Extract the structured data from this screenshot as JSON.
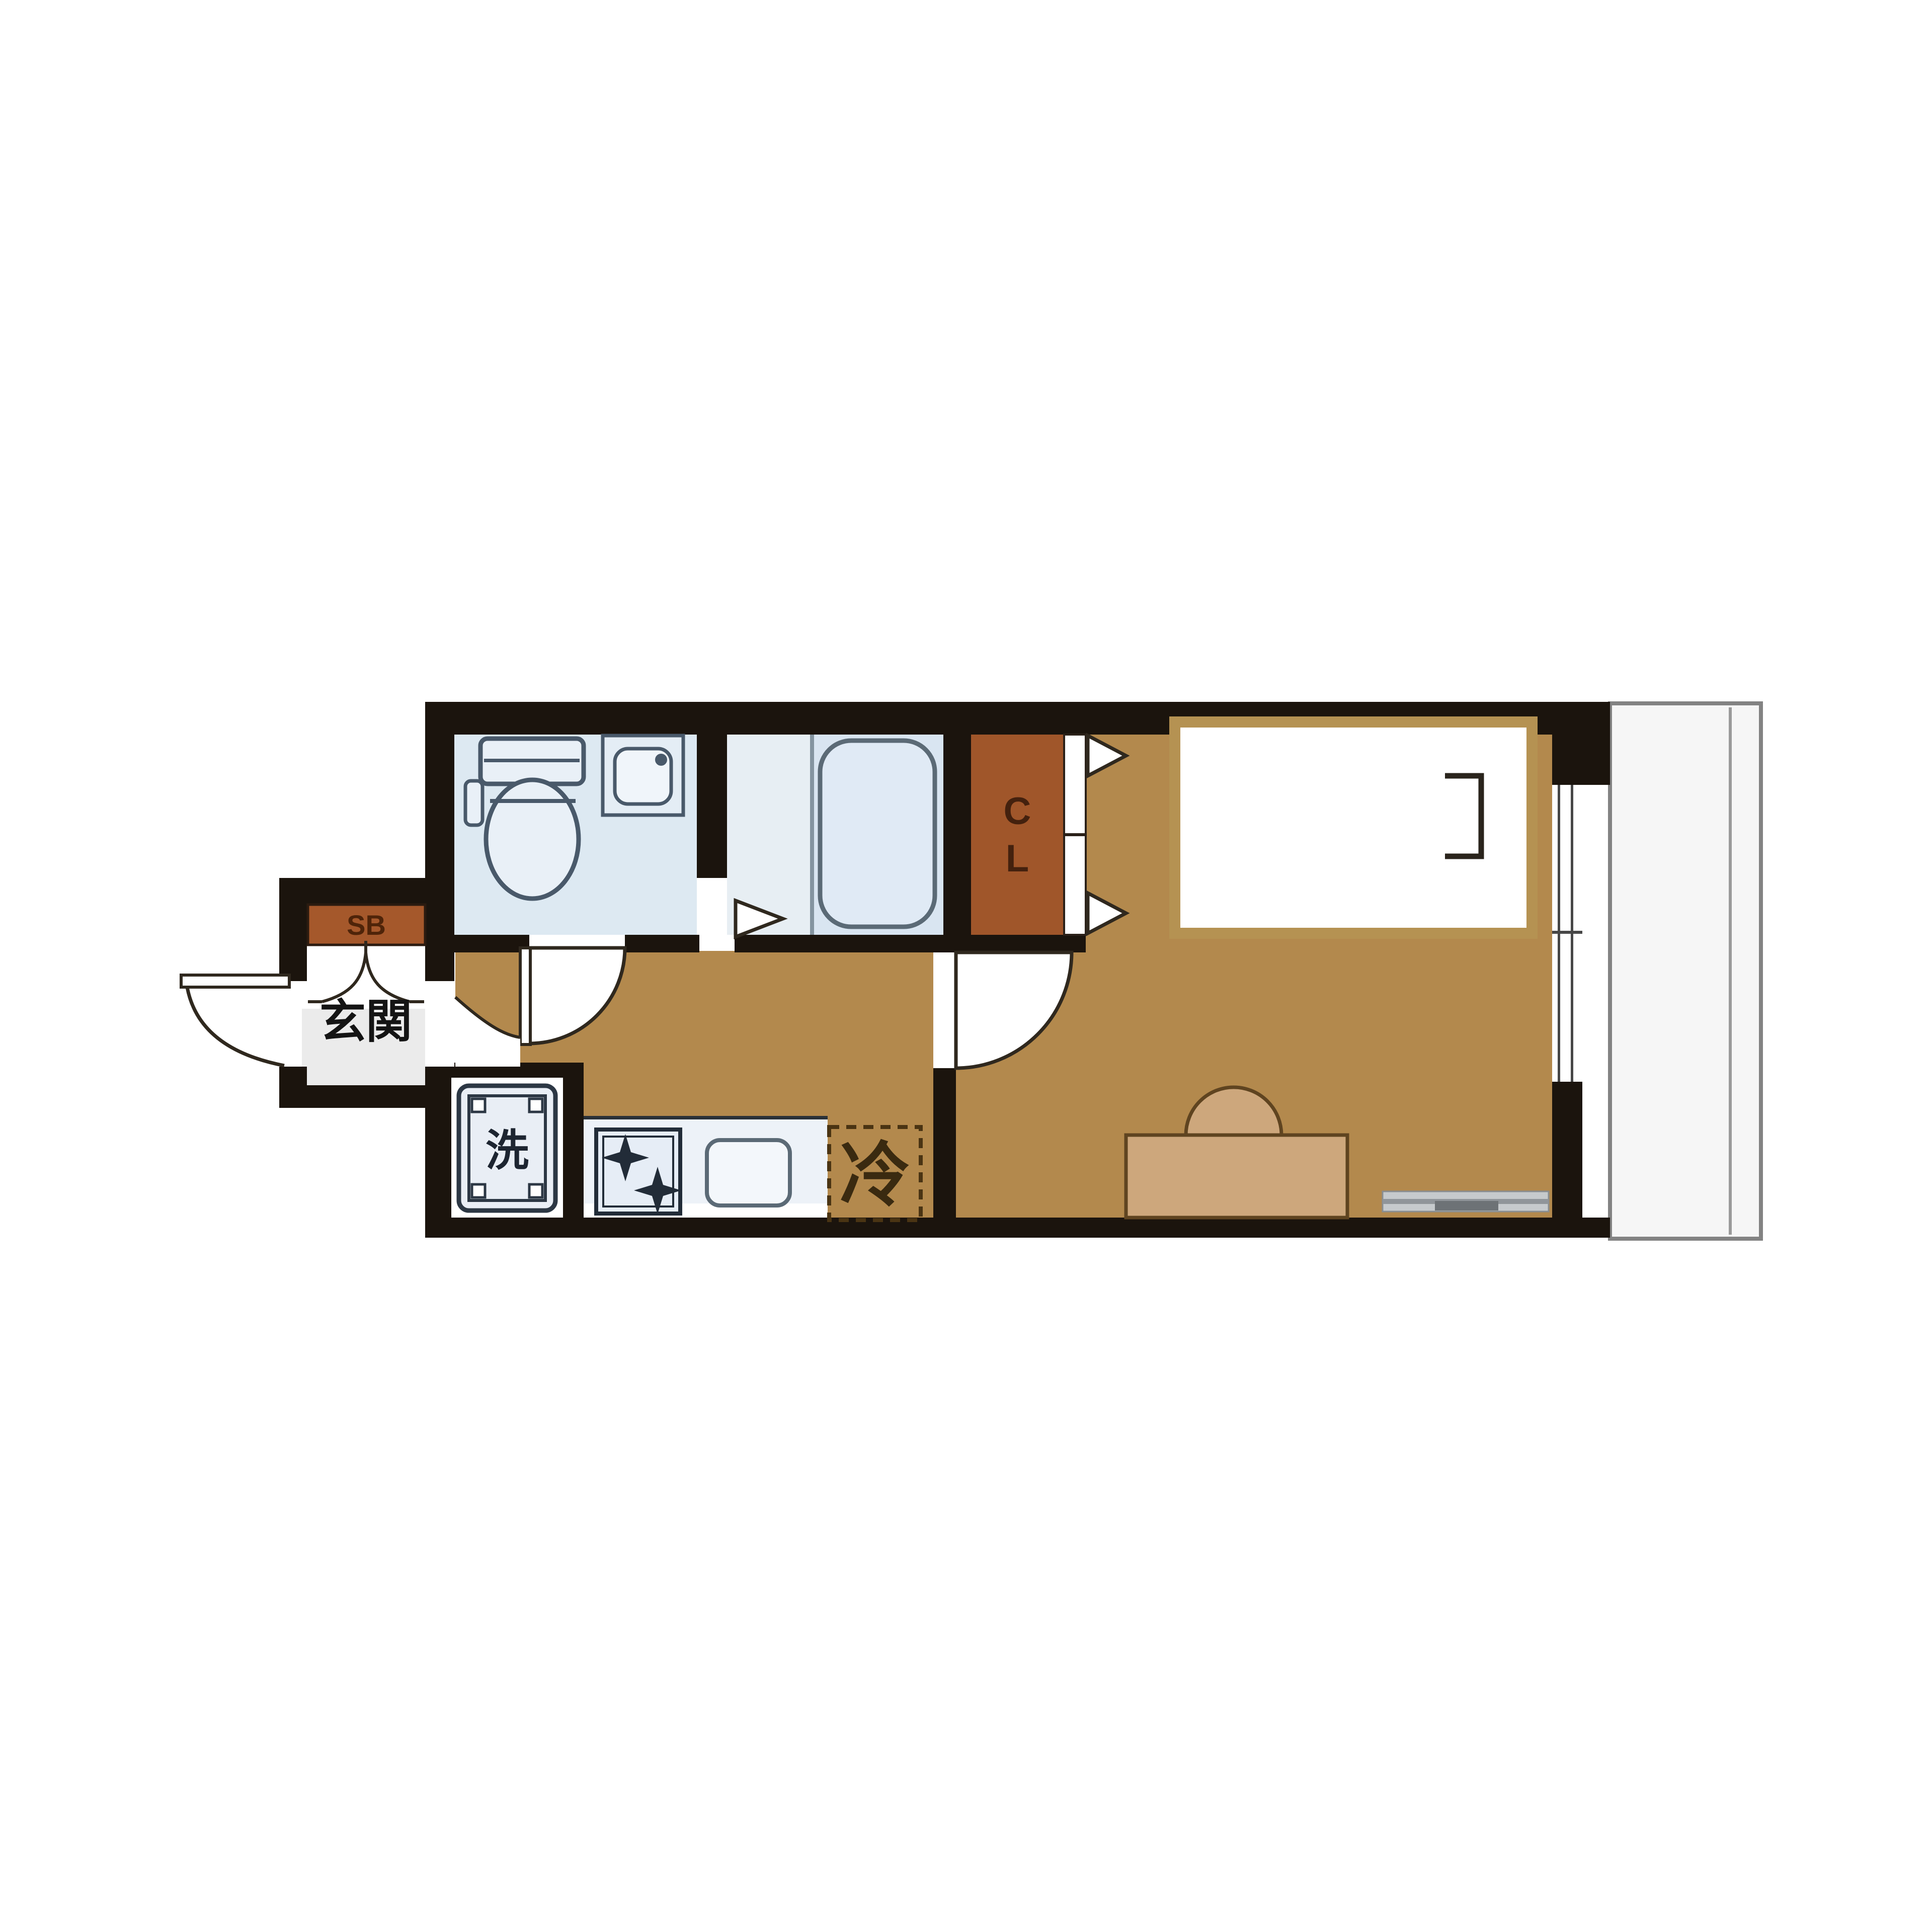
{
  "floorplan": {
    "labels": {
      "shoe_box": "SB",
      "entrance": "玄関",
      "closet_letters": [
        "C",
        "L"
      ],
      "washing_machine": "洗",
      "refrigerator": "冷"
    },
    "colors": {
      "wall": "#1b140d",
      "floor_wood": "#b3894d",
      "closet_brown": "#a0562a",
      "shoe_box_brown": "#a5582b",
      "wet_area_blue": "#dde9f2",
      "bath_blue": "#e7eef3",
      "entrance_gray": "#ebebeb",
      "balcony_gray": "#f6f6f6",
      "furniture_tan": "#cda77c",
      "bed_border_tan": "#b59252"
    },
    "rooms": [
      "toilet",
      "bathroom",
      "closet",
      "entrance",
      "hall-kitchen",
      "main-room",
      "balcony"
    ]
  }
}
